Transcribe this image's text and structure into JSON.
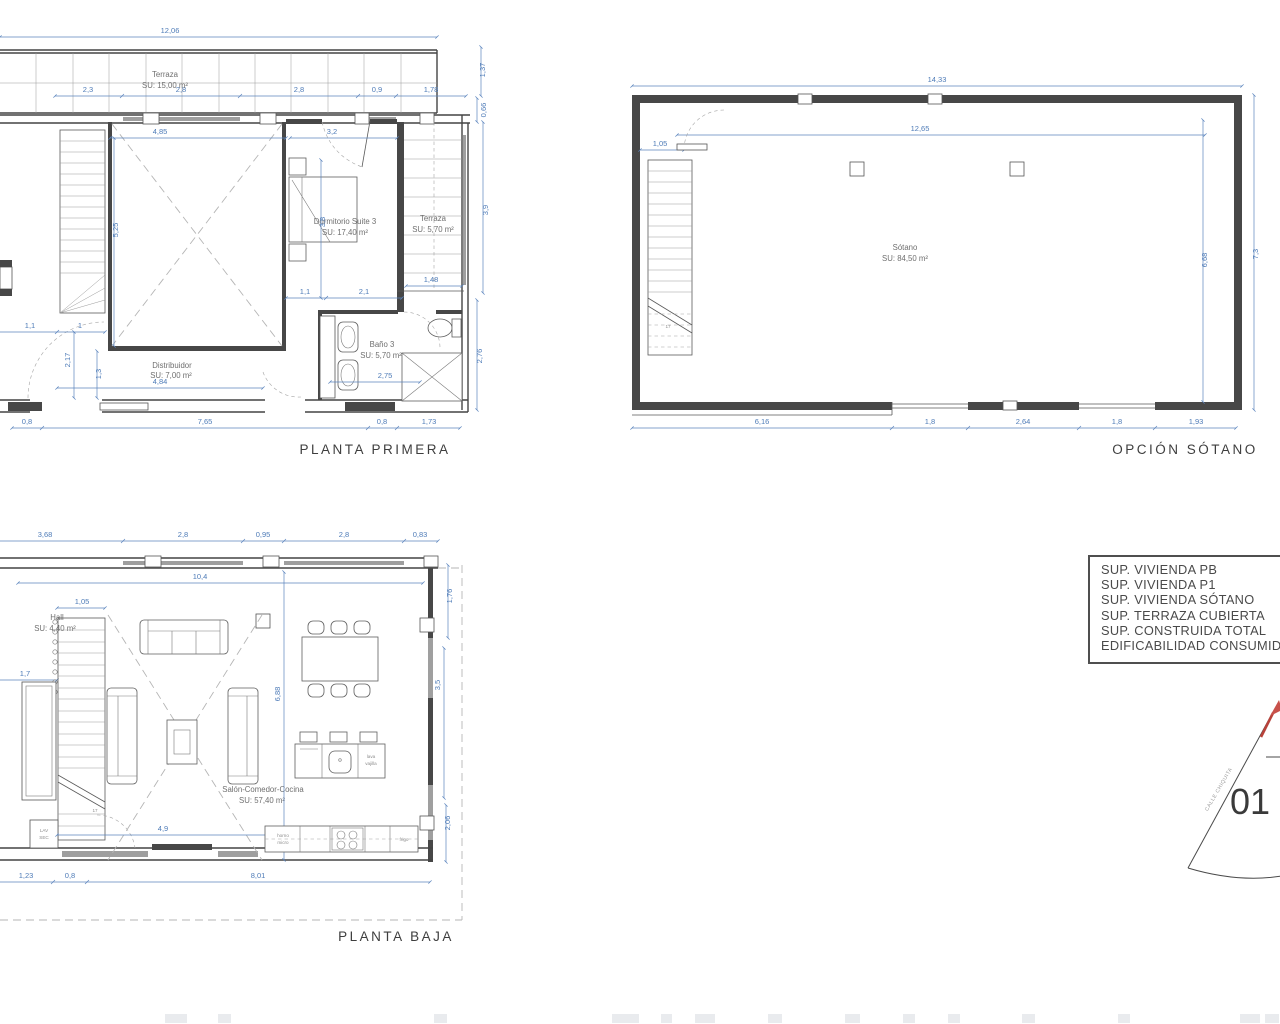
{
  "pp": {
    "title": "PLANTA PRIMERA",
    "rooms": {
      "terraza_cubierta": {
        "n": "Terraza",
        "a": "SU: 15,00 m²"
      },
      "dormitorio": {
        "n": "Dormitorio Suite 3",
        "a": "SU: 17,40 m²"
      },
      "terraza": {
        "n": "Terraza",
        "a": "SU: 5,70 m²"
      },
      "bano": {
        "n": "Baño 3",
        "a": "SU: 5,70 m²"
      },
      "distribuidor": {
        "n": "Distribuidor",
        "a": "SU: 7,00 m²"
      }
    },
    "dims": {
      "total": "12,06",
      "t": [
        "2,3",
        "2,8",
        "2,8",
        "0,9",
        "1,78"
      ],
      "r": [
        "1,37",
        "0,66",
        "3,9",
        "2,76"
      ],
      "w485": "4,85",
      "w32": "3,2",
      "v525": "5,25",
      "v38": "3,8",
      "m11": "1,1",
      "m21": "2,1",
      "m148": "1,48",
      "l11": "1,1",
      "l1": "1",
      "l217": "2,17",
      "l13": "1,3",
      "d484": "4,84",
      "d275": "2,75",
      "b": [
        "0,8",
        "7,65",
        "0,8",
        "1,73"
      ]
    }
  },
  "so": {
    "title": "OPCIÓN SÓTANO",
    "room": {
      "n": "Sótano",
      "a": "SU: 84,50 m²"
    },
    "dims": {
      "total": "14,33",
      "inner": "12,65",
      "s105": "1,05",
      "r668": "6,68",
      "r73": "7,3",
      "b": [
        "6,16",
        "1,8",
        "2,64",
        "1,8",
        "1,93"
      ]
    },
    "steps": "17"
  },
  "pb": {
    "title": "PLANTA BAJA",
    "rooms": {
      "hall": {
        "n": "Hall",
        "a": "SU: 4,40 m²"
      },
      "salon": {
        "n": "Salón-Comedor-Cocina",
        "a": "SU: 57,40 m²"
      }
    },
    "fixtures": {
      "lav1": "LAV",
      "lav2": "SEC",
      "k1": "horno",
      "k2": "micro",
      "fridge": "frigo",
      "isl1": "lava",
      "isl2": "vajilla"
    },
    "dims": {
      "t": [
        "3,68",
        "2,8",
        "0,95",
        "2,8",
        "0,83"
      ],
      "inner": "10,4",
      "h105": "1,05",
      "h17": "1,7",
      "v688": "6,88",
      "k49": "4,9",
      "b": [
        "1,23",
        "0,8",
        "8,01"
      ],
      "r": [
        "1,76",
        "3,5",
        "2,06"
      ]
    },
    "steps": "17"
  },
  "legend": {
    "lines": [
      "SUP. VIVIENDA PB",
      "SUP. VIVIENDA P1",
      "SUP. VIVIENDA SÓTANO",
      "SUP. TERRAZA CUBIERTA",
      "SUP. CONSTRUIDA TOTAL",
      "EDIFICABILIDAD CONSUMIDA"
    ]
  },
  "marker": {
    "number": "01",
    "street": "CALLE CHIQUITA"
  }
}
